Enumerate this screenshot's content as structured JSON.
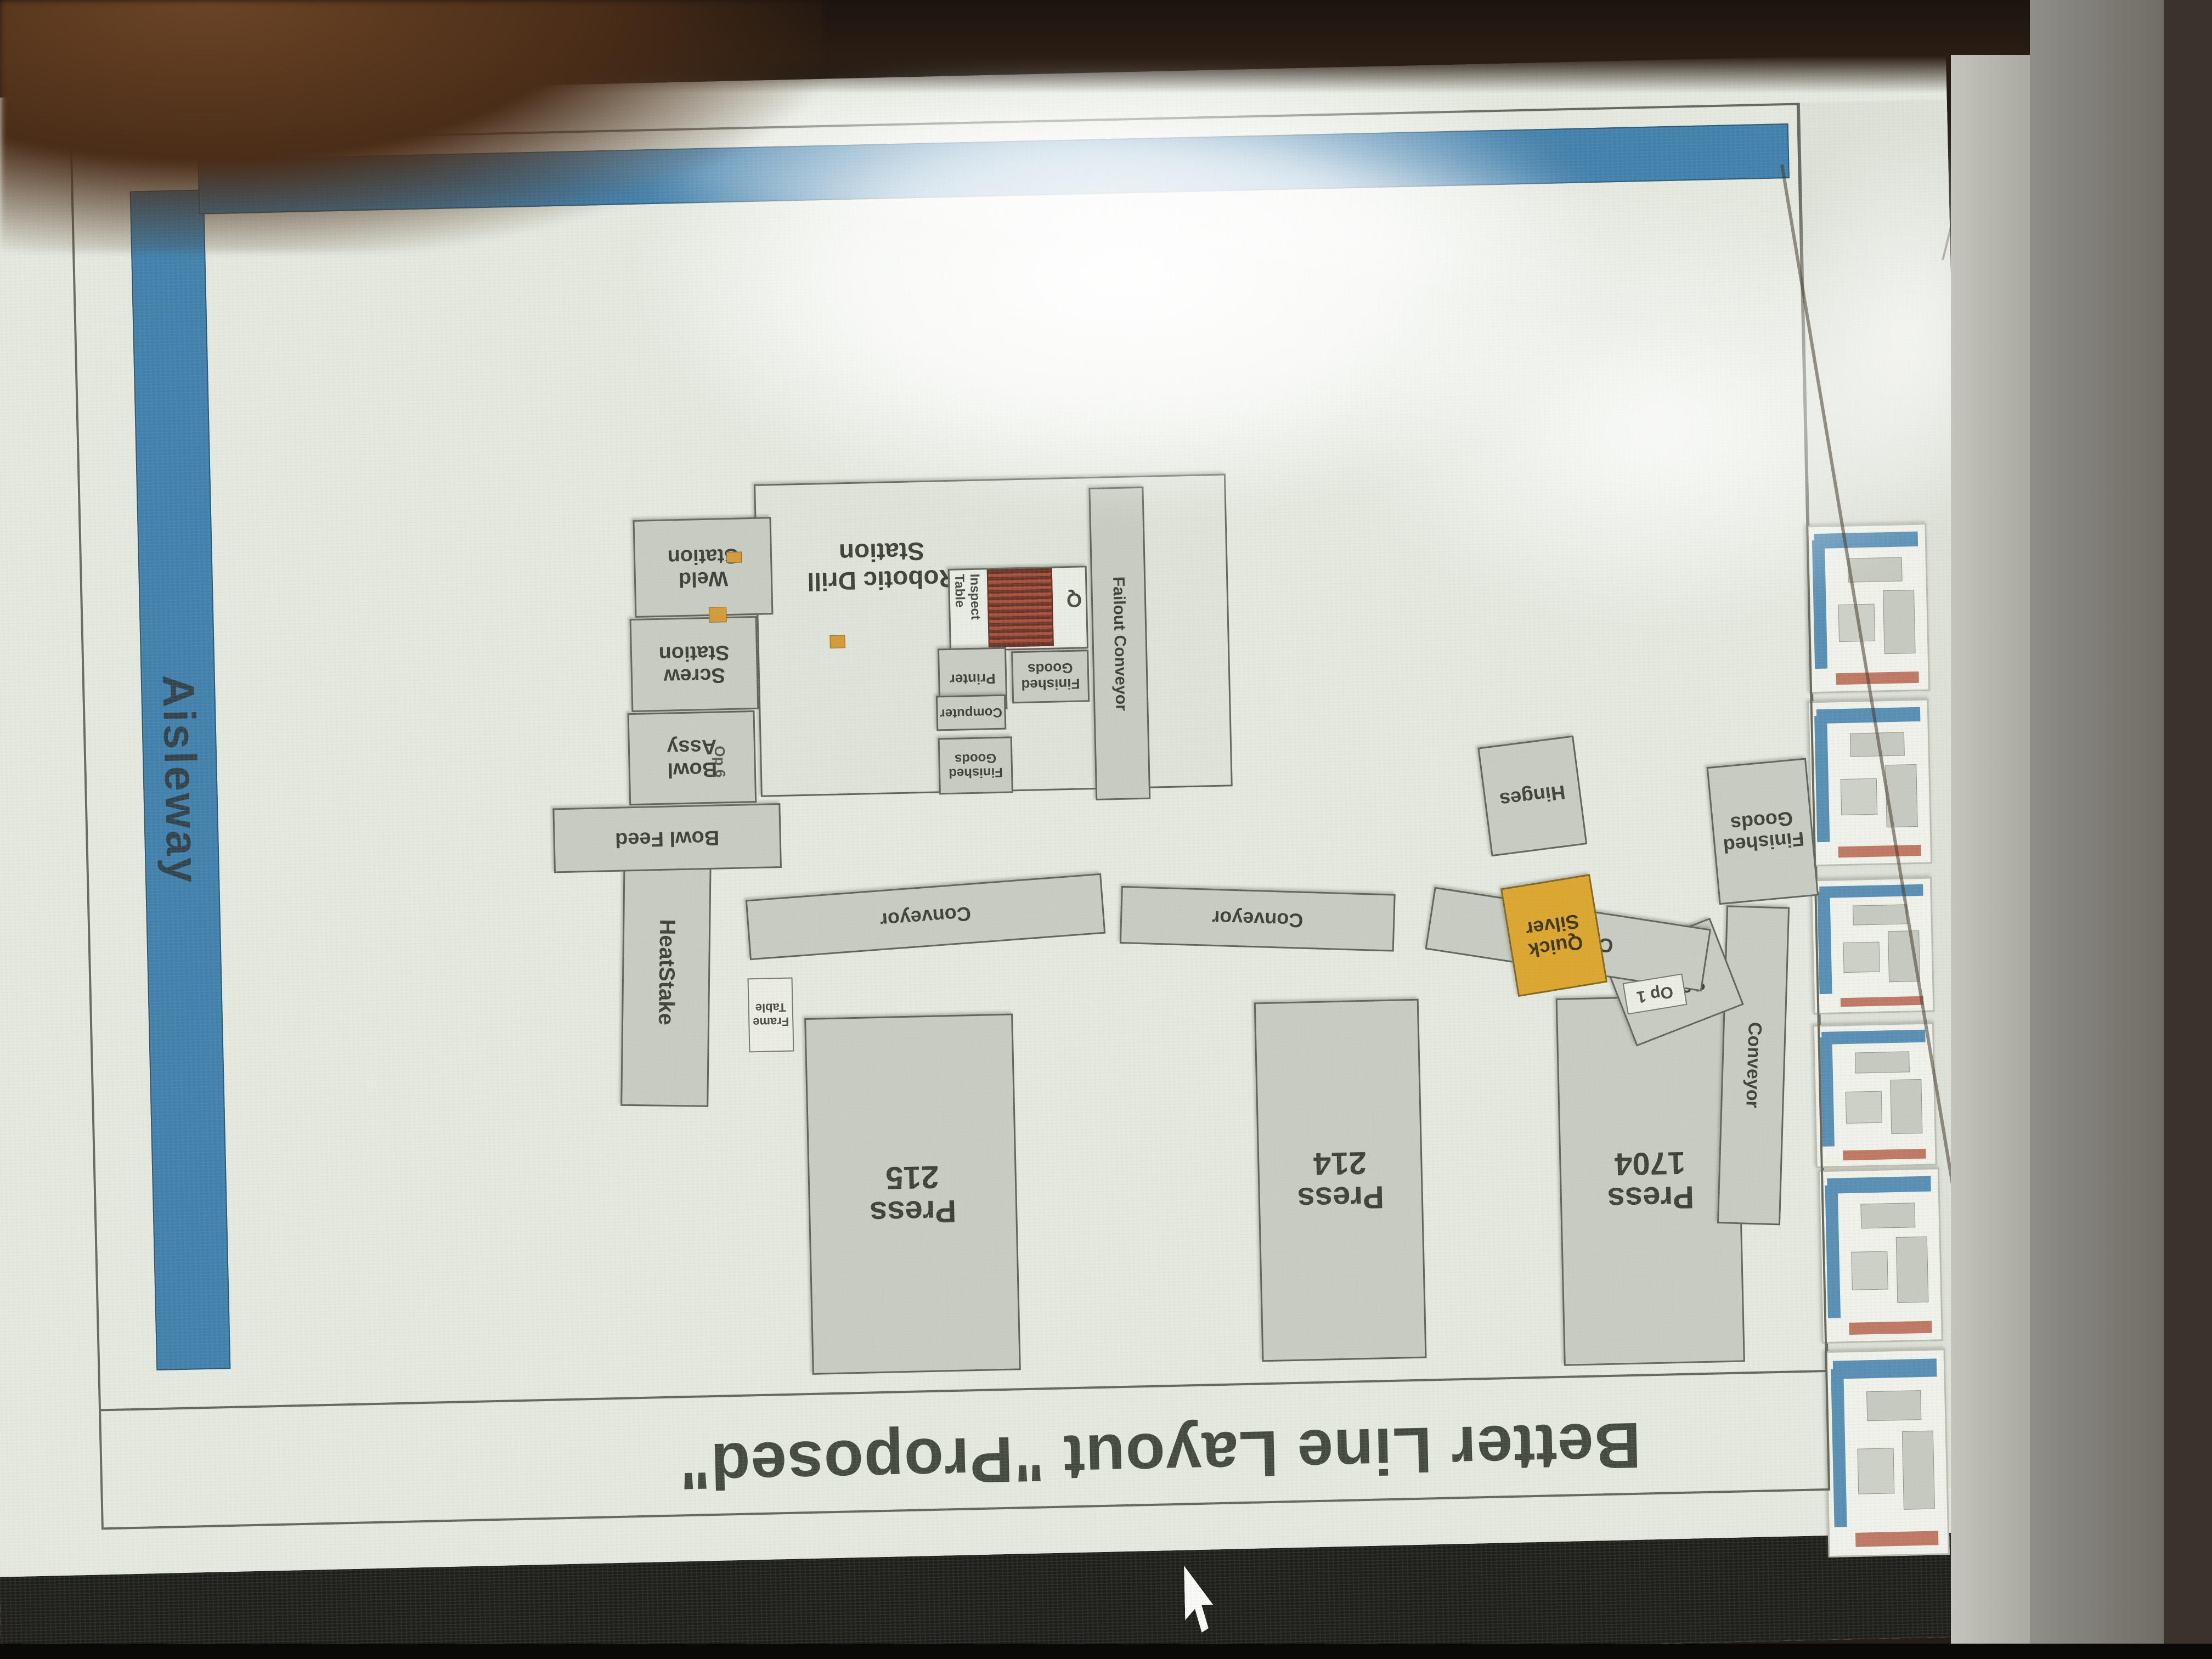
{
  "slide": {
    "title": "Better Line Layout \"Proposed\""
  },
  "labels": {
    "aisleway": "Aisleway",
    "conveyor": "Conveyor",
    "failout_conveyor": "Failout  Conveyor",
    "robotic_drill": "Robotic Drill\nStation",
    "weld_station": "Weld\nStation",
    "screw_station": "Screw\nStation",
    "bowl_assy": "Bowl\nAssy",
    "bowl_feed": "Bowl Feed",
    "heatstake": "HeatStake",
    "screw_robot": "Screw\nRobot",
    "hinges": "Hinges",
    "quick_silver": "Quick\nSilver",
    "finished_goods": "Finished\nGoods",
    "printer": "Printer",
    "computer": "Computer",
    "inspect_table": "Inspect\nTable",
    "frame_table": "Frame\nTable",
    "q_marker": "Q",
    "op1": "Op 1",
    "op6": "Op 6"
  },
  "presses": [
    {
      "label": "Press\n1704"
    },
    {
      "label": "Press\n214"
    },
    {
      "label": "Press\n215"
    }
  ],
  "colors": {
    "aisleway_blue": "#3277ab",
    "quick_silver_yellow": "#dfa11d",
    "reject_red": "#8e3226",
    "slide_background": "#e9ece5",
    "title_text": "#34392f",
    "cursor_white": "#ffffff"
  }
}
